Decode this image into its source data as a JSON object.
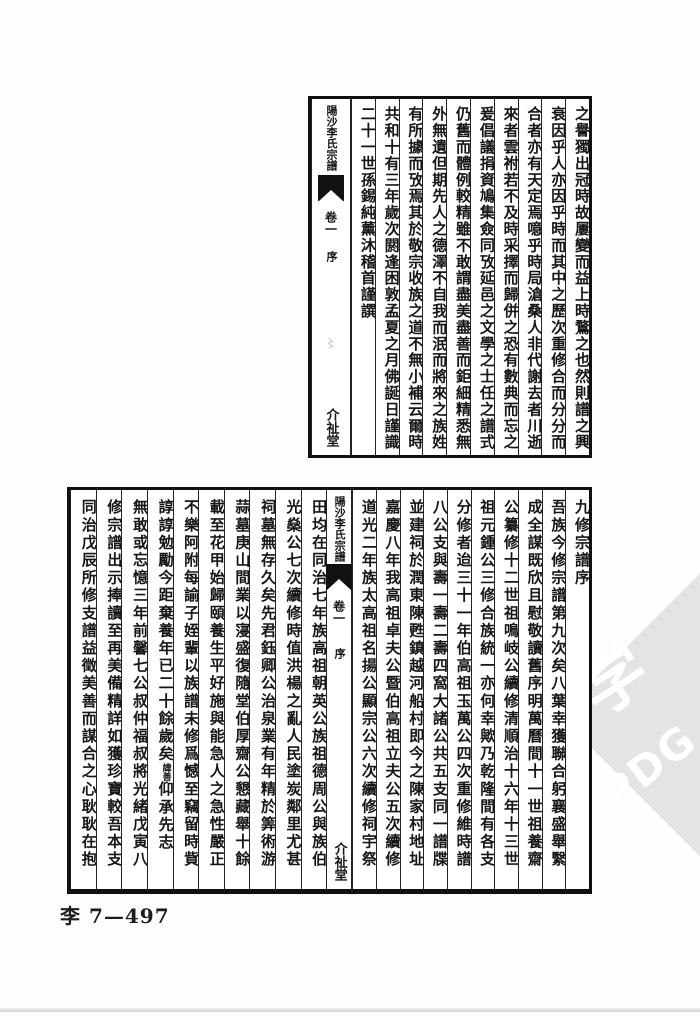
{
  "page": {
    "shelf_label": "李 7—497",
    "watermark": {
      "glyph": "学",
      "text": "PDG",
      "color": "#e4e4e4"
    }
  },
  "top_block": {
    "banxin": {
      "title": "陽沙李氏宗譜",
      "volume": "卷一",
      "section": "序",
      "hall": "介祉堂"
    },
    "columns": [
      "之譽獨出冠時故屢變而益上時鶩之也然則譜之興",
      "衰因乎人亦因乎時而其中之歷次重修合而分分而",
      "合者亦有天定焉噫乎時局滄桑人非代謝去者川逝",
      "來者雲祔若不及時采擇而歸併之恐有數典而忘之",
      "爰倡議捐資鳩集僉同攷延邑之文學之士任之譜式",
      "仍舊而體例較精雖不敢謂盡美盡善而鉅細精悉無",
      "外無遺但期先人之德澤不自我而泯而將來之族姓",
      "有所據而攷焉其於敬宗收族之道不無小補云爾時",
      "共和十有三年歲次閼逢困敦孟夏之月佛誕日謹識",
      "二十一世孫錫純薰沐稽首謹譔"
    ]
  },
  "bottom_block": {
    "banxin": {
      "title": "陽沙李氏宗譜",
      "volume": "卷一",
      "section": "序",
      "hall": "介祉堂"
    },
    "right_columns": [
      "九修宗譜序",
      "吾族今修宗譜第九次矣八葉幸獲聯合躬襄盛舉繄",
      "成全謀既欣且慰敬讀舊序明萬曆間十一世祖養齋",
      "公纂修十二世祖鳴岐公續修清順治十六年十三世",
      "祖元鍾公三修合族統一亦何幸歟乃乾隆間有各支",
      "分修者迨三十一年伯高祖玉萬公四次重修維時譜",
      "八公支與壽一壽二壽四窩大諸公共五支同一譜牒",
      "並建祠於潤東陳甦鎮越河船村即今之陳家村地址",
      "嘉慶八年我高祖卓夫公暨伯高祖立夫公五次續修",
      "道光二年族太高祖名揚公顯宗公六次續修祠宇祭"
    ],
    "left_columns": [
      "田均在同治七年族高祖朝英公族祖德周公與族伯",
      "光燊公七次續修時值洪楊之亂人民塗炭鄰里尤甚",
      "祠墓無存久矣先君鈺卿公治泉業有年精於筭術游",
      "蒜墓庚山間業以寖盛復隨堂伯厚齋公懇藏舉十餘",
      "載至花甲始歸頤養生平好施與能急人之急性嚴正",
      "不樂阿附每諭子姪輩以族譜未修爲憾至竊留時貲",
      {
        "pre": "諄諄勉勵今距棄養年已二十餘歲矣",
        "note": "諱善",
        "post": "仰承先志"
      },
      "無敢或忘憶三年前馨七公叔仲福叔將光緒戊寅八",
      "修宗譜出示捧讀至再美備精詳如獲珍寶較吾本支",
      "同治戊辰所修支譜益徵美善而謀合之心耿耿在抱"
    ]
  }
}
